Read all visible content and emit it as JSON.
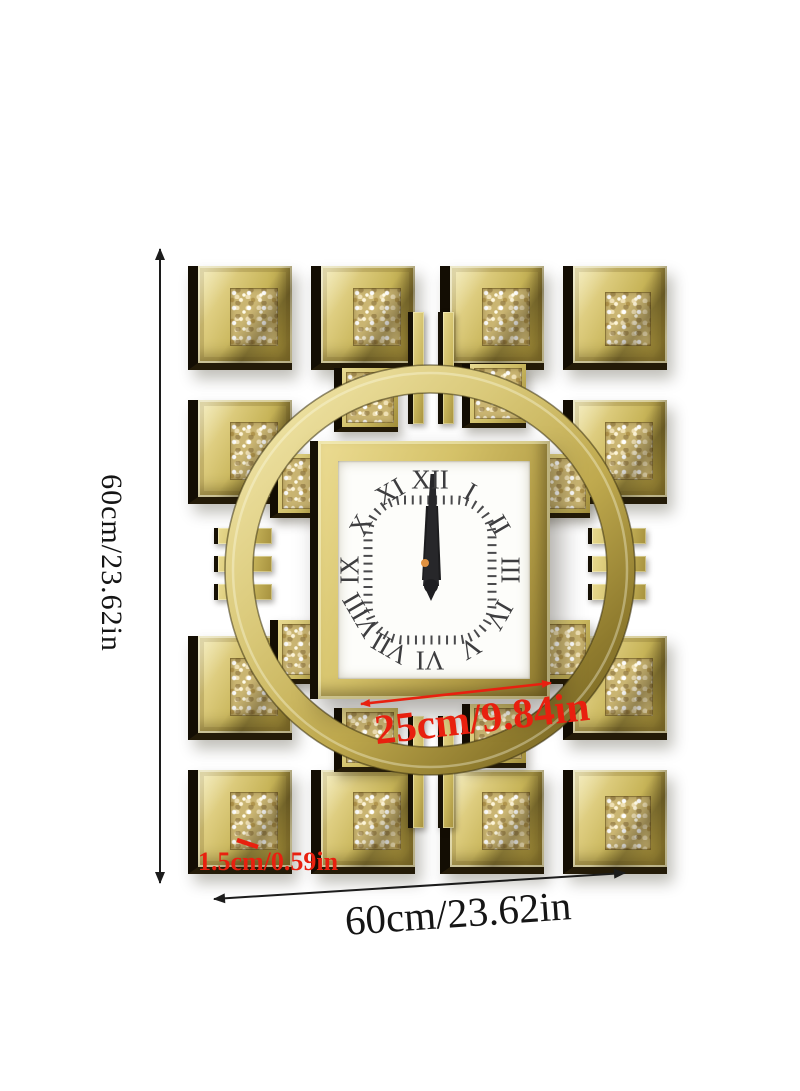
{
  "annotations": {
    "height_label": "60cm/23.62in",
    "width_label": "60cm/23.62in",
    "dial_width_label": "25cm/9.84in",
    "thickness_label": "1.5cm/0.59in"
  },
  "clock": {
    "numerals": [
      "XII",
      "I",
      "II",
      "III",
      "IV",
      "V",
      "VI",
      "VII",
      "VIII",
      "IX",
      "X",
      "XI"
    ],
    "time_shown": "12:00"
  },
  "colors": {
    "gold_light": "#f0e5a8",
    "gold": "#cdbb62",
    "gold_dark": "#8a7830",
    "mirror_side": "#130d03",
    "dial": "#fdfdfa",
    "numeral": "#3d3d3f",
    "hand": "#27272a",
    "center_pin_orange": "#e09140",
    "accent_red": "#e8200f",
    "dimension_line": "#1c1c1c"
  }
}
